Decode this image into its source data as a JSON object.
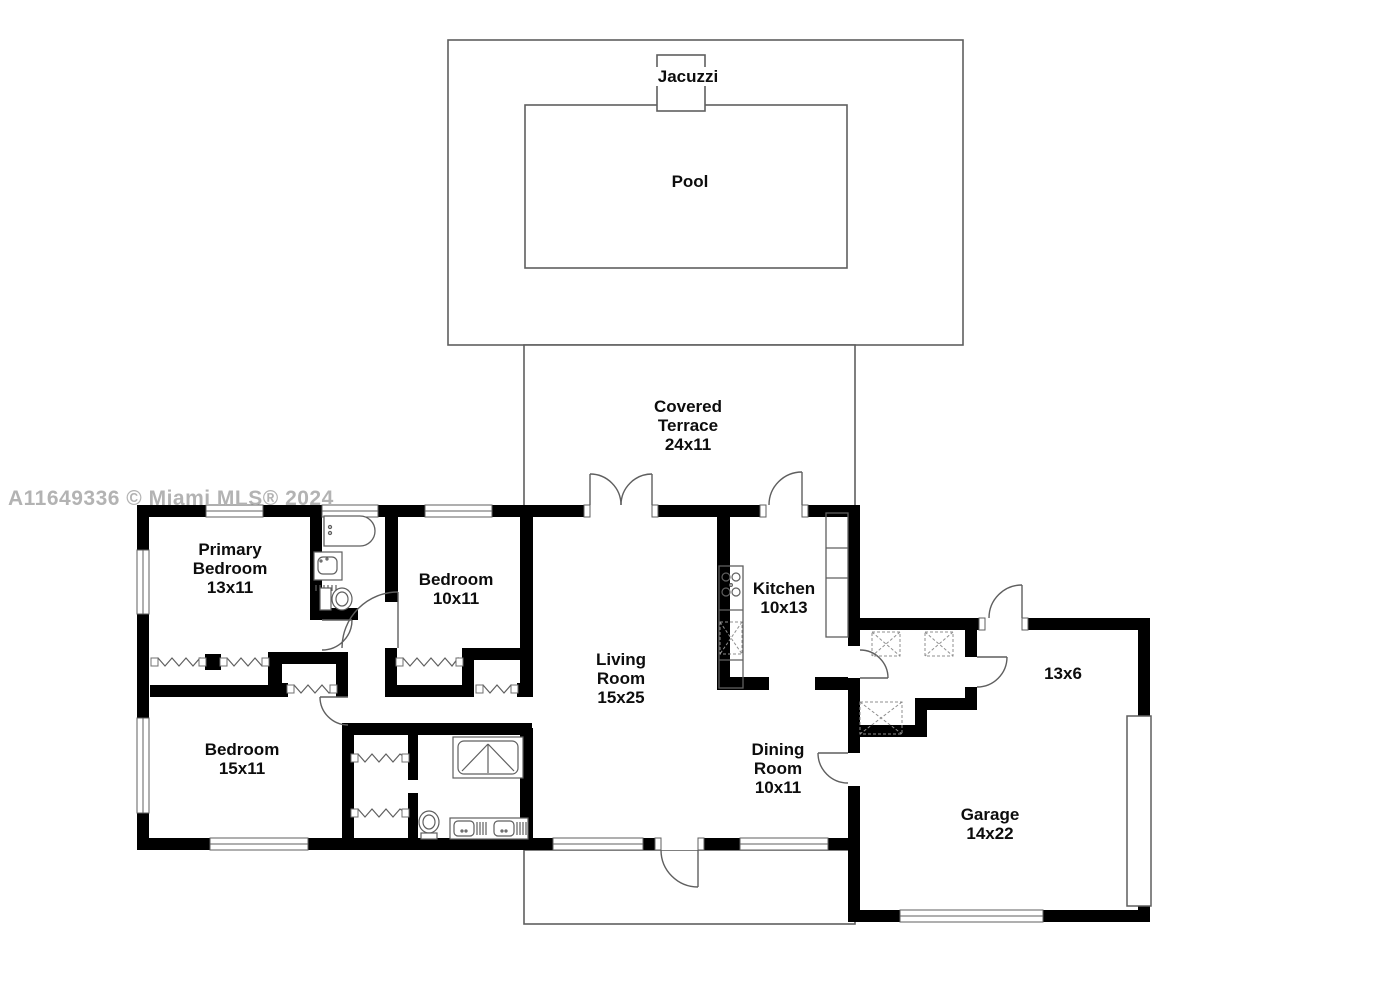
{
  "watermark": "A11649336 © Miami MLS® 2024",
  "colors": {
    "wall": "#000000",
    "line": "#5f5f5f",
    "dashed": "#8f8f8f",
    "label": "#0d0d0d",
    "watermark": "#b3b3b3"
  },
  "rooms": {
    "jacuzzi": {
      "name": "Jacuzzi"
    },
    "pool": {
      "name": "Pool"
    },
    "terrace": {
      "name": "Covered Terrace",
      "dims": "24x11"
    },
    "primary_bedroom": {
      "name": "Primary Bedroom",
      "dims": "13x11"
    },
    "bedroom2": {
      "name": "Bedroom",
      "dims": "10x11"
    },
    "kitchen": {
      "name": "Kitchen",
      "dims": "10x13"
    },
    "living": {
      "name": "Living Room",
      "dims": "15x25"
    },
    "bedroom3": {
      "name": "Bedroom",
      "dims": "15x11"
    },
    "dining": {
      "name": "Dining Room",
      "dims": "10x11"
    },
    "garage": {
      "name": "Garage",
      "dims": "14x22"
    },
    "storage": {
      "dims": "13x6"
    }
  },
  "icons": [
    "bathtub",
    "sink",
    "toilet",
    "shower",
    "double-vanity",
    "cooktop",
    "washer-dryer-box",
    "closet-rod",
    "garage-door",
    "door-swing",
    "window"
  ]
}
